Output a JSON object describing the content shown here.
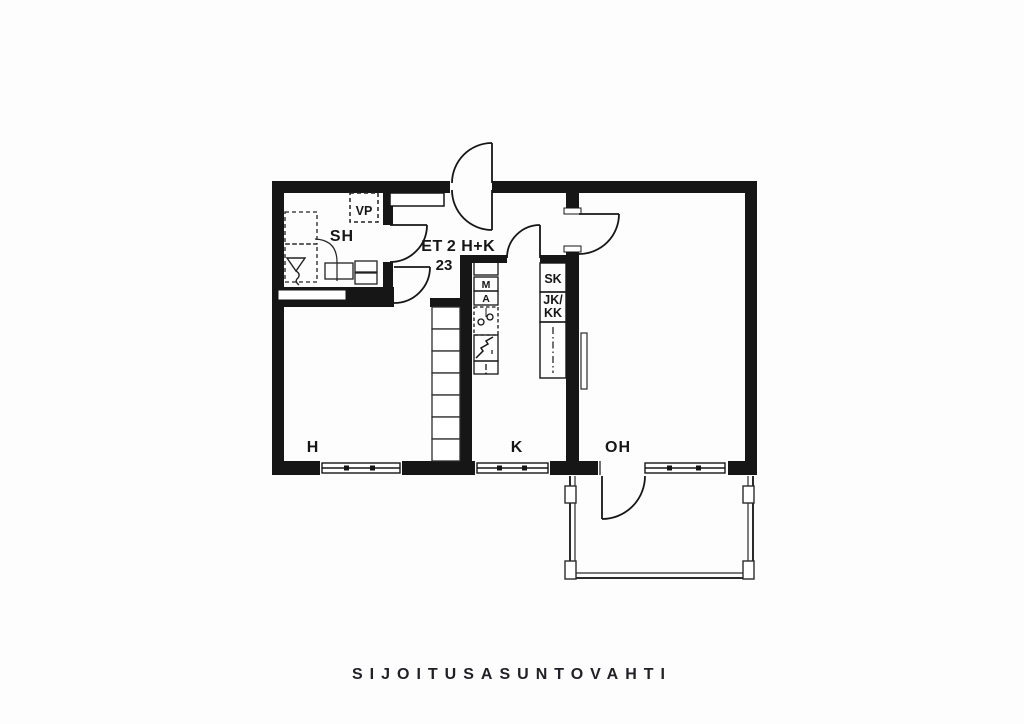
{
  "brand": {
    "name": "SIJOITUSASUNTOVAHTI"
  },
  "plan": {
    "title": {
      "room": "ET",
      "type": "2 H+K",
      "area": "23"
    },
    "rooms": {
      "sh": {
        "label": "SH"
      },
      "h": {
        "label": "H"
      },
      "k": {
        "label": "K"
      },
      "oh": {
        "label": "OH"
      }
    },
    "fixtures": {
      "vp": {
        "label": "VP"
      },
      "sk": {
        "label": "SK"
      },
      "jkkk": {
        "line1": "JK/",
        "line2": "KK"
      },
      "appliance_m": {
        "label": "M"
      },
      "appliance_a": {
        "label": "A"
      }
    },
    "colors": {
      "wall": "#161616",
      "thin_line": "#2b2b2b",
      "paper": "#fdfdfd"
    }
  }
}
